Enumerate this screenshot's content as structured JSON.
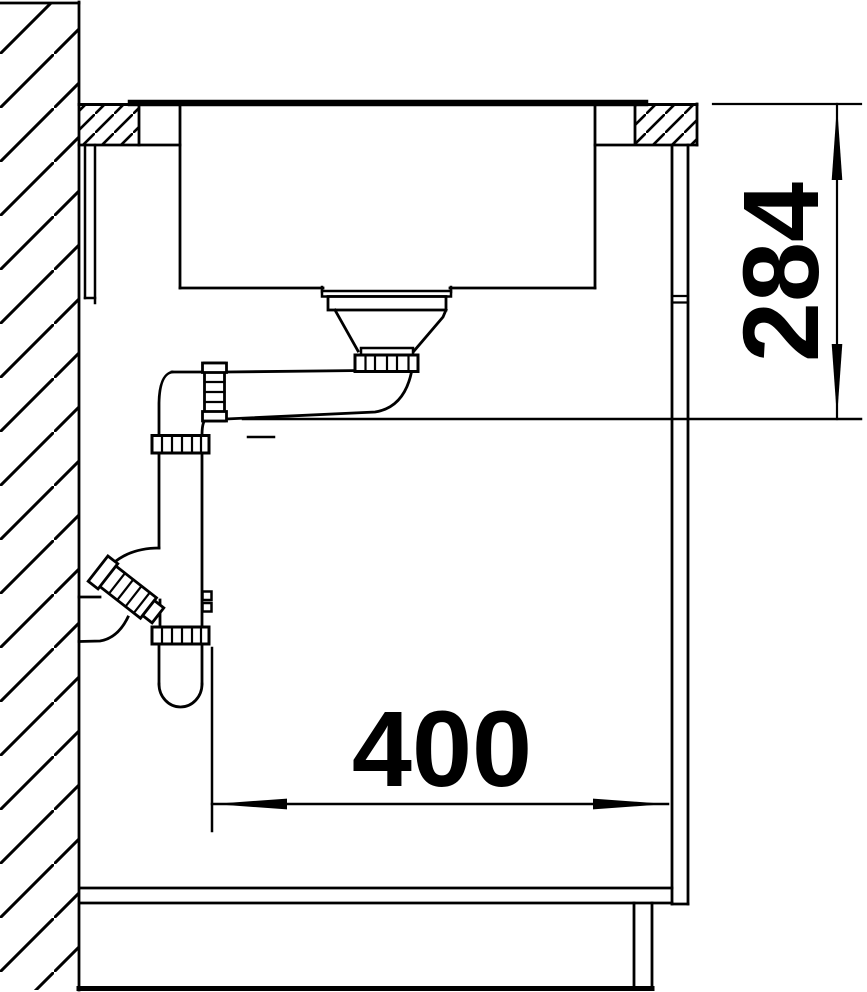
{
  "drawing": {
    "line_color": "#000000",
    "background_color": "#ffffff",
    "dimensions": {
      "worktop_to_outlet_height": {
        "label": "284"
      },
      "trap_clearance_width": {
        "label": "400"
      }
    }
  }
}
